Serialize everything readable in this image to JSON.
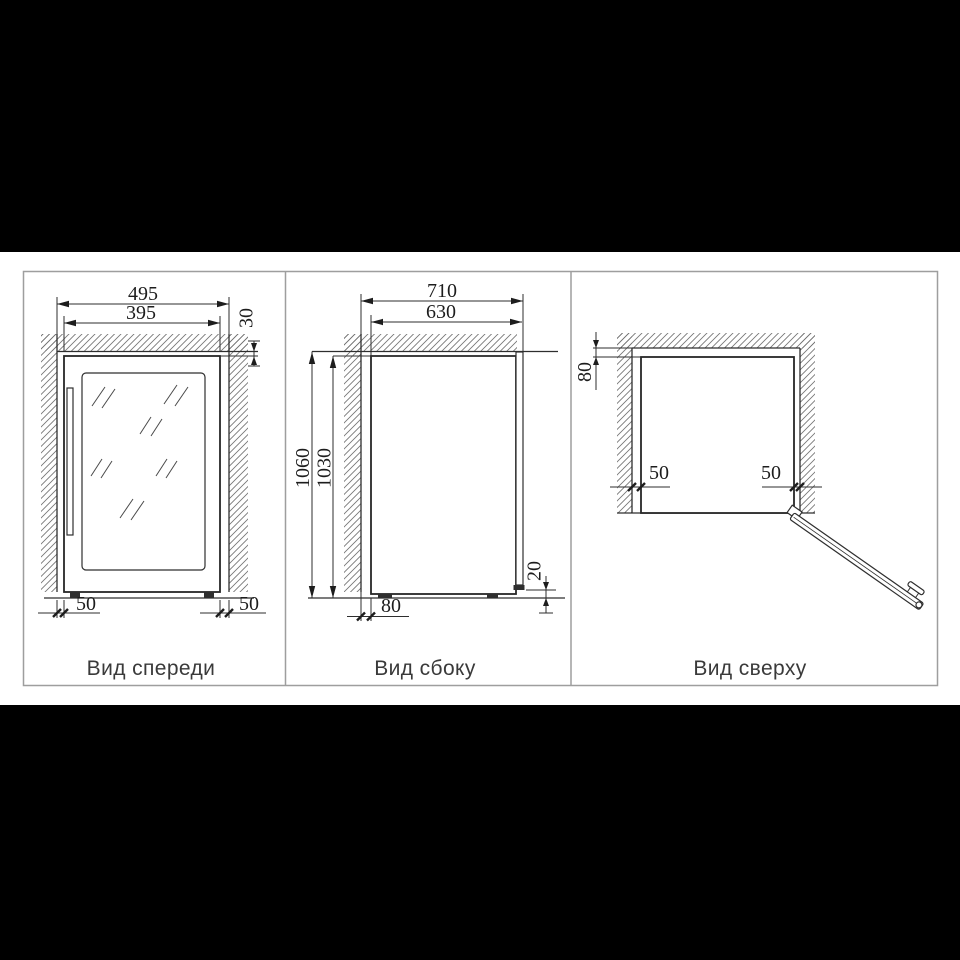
{
  "background": {
    "letterbox_color": "#000000",
    "paper_color": "#ffffff"
  },
  "panel": {
    "border_color": "#9e9e9e"
  },
  "style": {
    "line_color": "#2e2e2e",
    "dim_text_color": "#1d1d1d",
    "hatch_color": "#757575",
    "caption_color": "#3a3a3a"
  },
  "views": {
    "front": {
      "caption": "Вид спереди",
      "dim_niche_width": "495",
      "dim_unit_width": "395",
      "dim_top_gap": "30",
      "dim_left_gap": "50",
      "dim_right_gap": "50"
    },
    "side": {
      "caption": "Вид сбоку",
      "dim_niche_depth": "710",
      "dim_unit_depth": "630",
      "dim_niche_height": "1060",
      "dim_unit_height": "1030",
      "dim_back_gap": "80",
      "dim_bottom_gap": "20"
    },
    "top": {
      "caption": "Вид сверху",
      "dim_back_gap": "80",
      "dim_left_gap": "50",
      "dim_right_gap": "50"
    }
  }
}
